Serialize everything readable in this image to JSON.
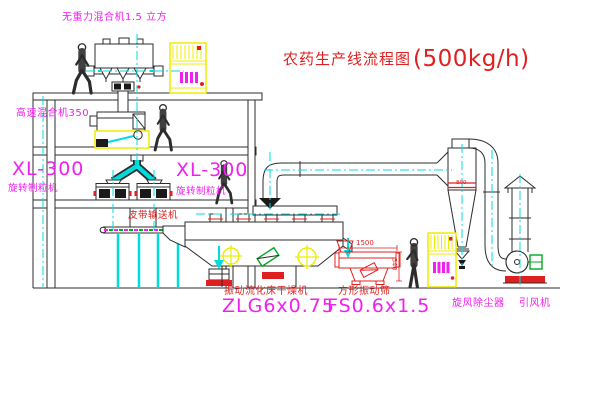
{
  "title": {
    "name": "农药生产线流程图",
    "capacity": "(500kg/h)"
  },
  "labels": {
    "gravity_mixer": "无重力混合机1.5 立方",
    "high_speed_mixer": "高速混合机350",
    "granulator_left_model": "XL-300",
    "granulator_left_name": "旋转制粒机",
    "granulator_right_model": "XL-300",
    "granulator_right_name": "旋转制粒机",
    "belt_conveyor": "皮带输送机",
    "dryer_name": "振动流化床干燥机",
    "dryer_model": "ZLG6x0.75",
    "screen_name": "方形振动筛",
    "screen_model": "FS0.6x1.5",
    "cyclone": "旋风除尘器",
    "fan": "引风机"
  },
  "dimensions": {
    "screen_length": "1500",
    "screen_height": "340",
    "cyclone_diameter": "800"
  },
  "colors": {
    "magenta": "#f020f0",
    "red": "#e02020",
    "cyan": "#00dcdc",
    "yellow": "#f0ec00",
    "green": "#00aa22",
    "line": "#2c2c2c"
  }
}
